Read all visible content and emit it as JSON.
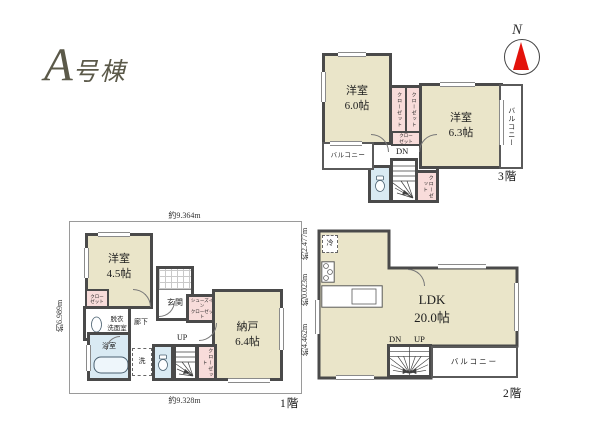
{
  "title_letter": "A",
  "title_suffix": "号棟",
  "compass_n": "N",
  "colors": {
    "wall": "#4a4a4a",
    "room_fill": "#eae5c9",
    "closet_fill": "#f8dcda",
    "wet_area_fill": "#d9eaf3",
    "compass_red": "#e3120b",
    "title_text": "#5b5949"
  },
  "floor3": {
    "label": "3階",
    "room_a": "洋室\n6.0帖",
    "room_b": "洋室\n6.3帖",
    "balcony_left": "バルコニー",
    "balcony_right": "バルコニー",
    "closet_a": "クローゼット",
    "closet_b": "クローゼット",
    "closet_c": "クローゼット",
    "closet_top": "クロー\nゼット",
    "stairs_dn": "DN"
  },
  "floor2": {
    "label": "2階",
    "ldk": "LDK\n20.0帖",
    "balcony": "バルコニー",
    "fridge": "冷",
    "stairs_dn": "DN",
    "stairs_up": "UP"
  },
  "floor1": {
    "label": "1階",
    "room": "洋室\n4.5帖",
    "storage": "納戸\n6.4帖",
    "entrance": "玄関",
    "shoe_closet": "シューズイン\nクローゼット",
    "washroom": "脱衣\n洗面室",
    "bath": "浴室",
    "hallway": "廊下",
    "closet_a": "クロー\nゼット",
    "closet_b": "クローゼット",
    "washer": "洗",
    "stairs_up": "UP",
    "dim_top": "約9.364m",
    "dim_bottom": "約9.328m",
    "dim_left": "約6.989m",
    "dim_right_1": "約2.477m",
    "dim_right_2": "約0.023m",
    "dim_right_3": "約4.462m"
  }
}
